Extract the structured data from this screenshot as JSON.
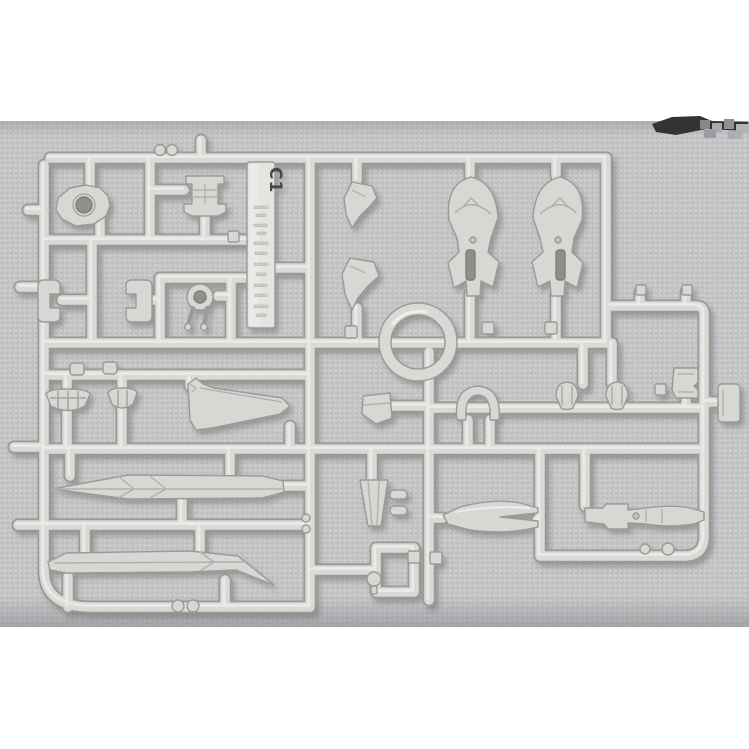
{
  "photo": {
    "subject": "model-kit parts runner on fabric",
    "tag_label": "C1",
    "colors": {
      "margin": "#ffffff",
      "fabric": "#c2c3c5",
      "plastic": "#d9dad6",
      "plastic_outline": "#999a95",
      "plastic_highlight": "#ecede9",
      "tag_plastic": "#e4e5e1",
      "tag_text": "#45464a",
      "smudge_dark": "#333335"
    },
    "parts": [
      "head-vent-part",
      "chest-block-part",
      "clamp-bracket-left",
      "clamp-bracket-right",
      "eye-ring-part",
      "claw-part-upper",
      "claw-part-lower",
      "shin-armor-left",
      "shin-armor-right",
      "large-ring-part",
      "angle-plate-part",
      "arch-handle-part",
      "shield-shell-left",
      "shield-shell-right",
      "box-detail-part",
      "sole-vent-left",
      "sole-vent-right",
      "wing-blade-part",
      "long-blade-upper",
      "long-blade-lower",
      "nozzle-cone-part",
      "forked-funnel-part",
      "rifle-part",
      "outer-clip-part"
    ]
  }
}
